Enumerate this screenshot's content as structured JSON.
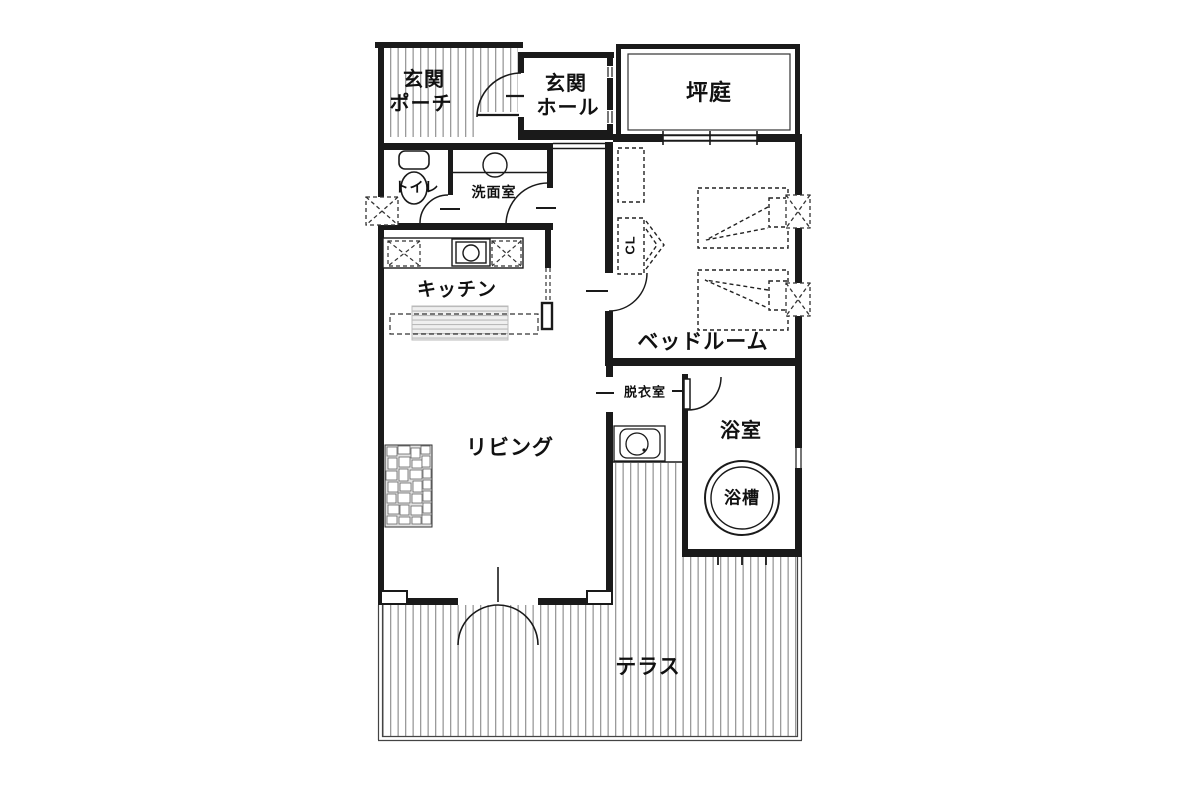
{
  "rooms": {
    "porch": {
      "line1": "玄関",
      "line2": "ポーチ"
    },
    "hall": {
      "line1": "玄関",
      "line2": "ホール"
    },
    "courtyard": {
      "label": "坪庭"
    },
    "toilet": {
      "label": "トイレ"
    },
    "washroom": {
      "label": "洗面室"
    },
    "kitchen": {
      "label": "キッチン"
    },
    "closet": {
      "label": "CL"
    },
    "bedroom": {
      "label": "ベッドルーム"
    },
    "dressing": {
      "label": "脱衣室"
    },
    "living": {
      "label": "リビング"
    },
    "bath": {
      "label": "浴室"
    },
    "bathtub": {
      "label": "浴槽"
    },
    "terrace": {
      "label": "テラス"
    }
  },
  "colors": {
    "wall": "#1a1a1a",
    "hatch": "#9a9a9a",
    "text": "#111111",
    "background": "#ffffff"
  }
}
